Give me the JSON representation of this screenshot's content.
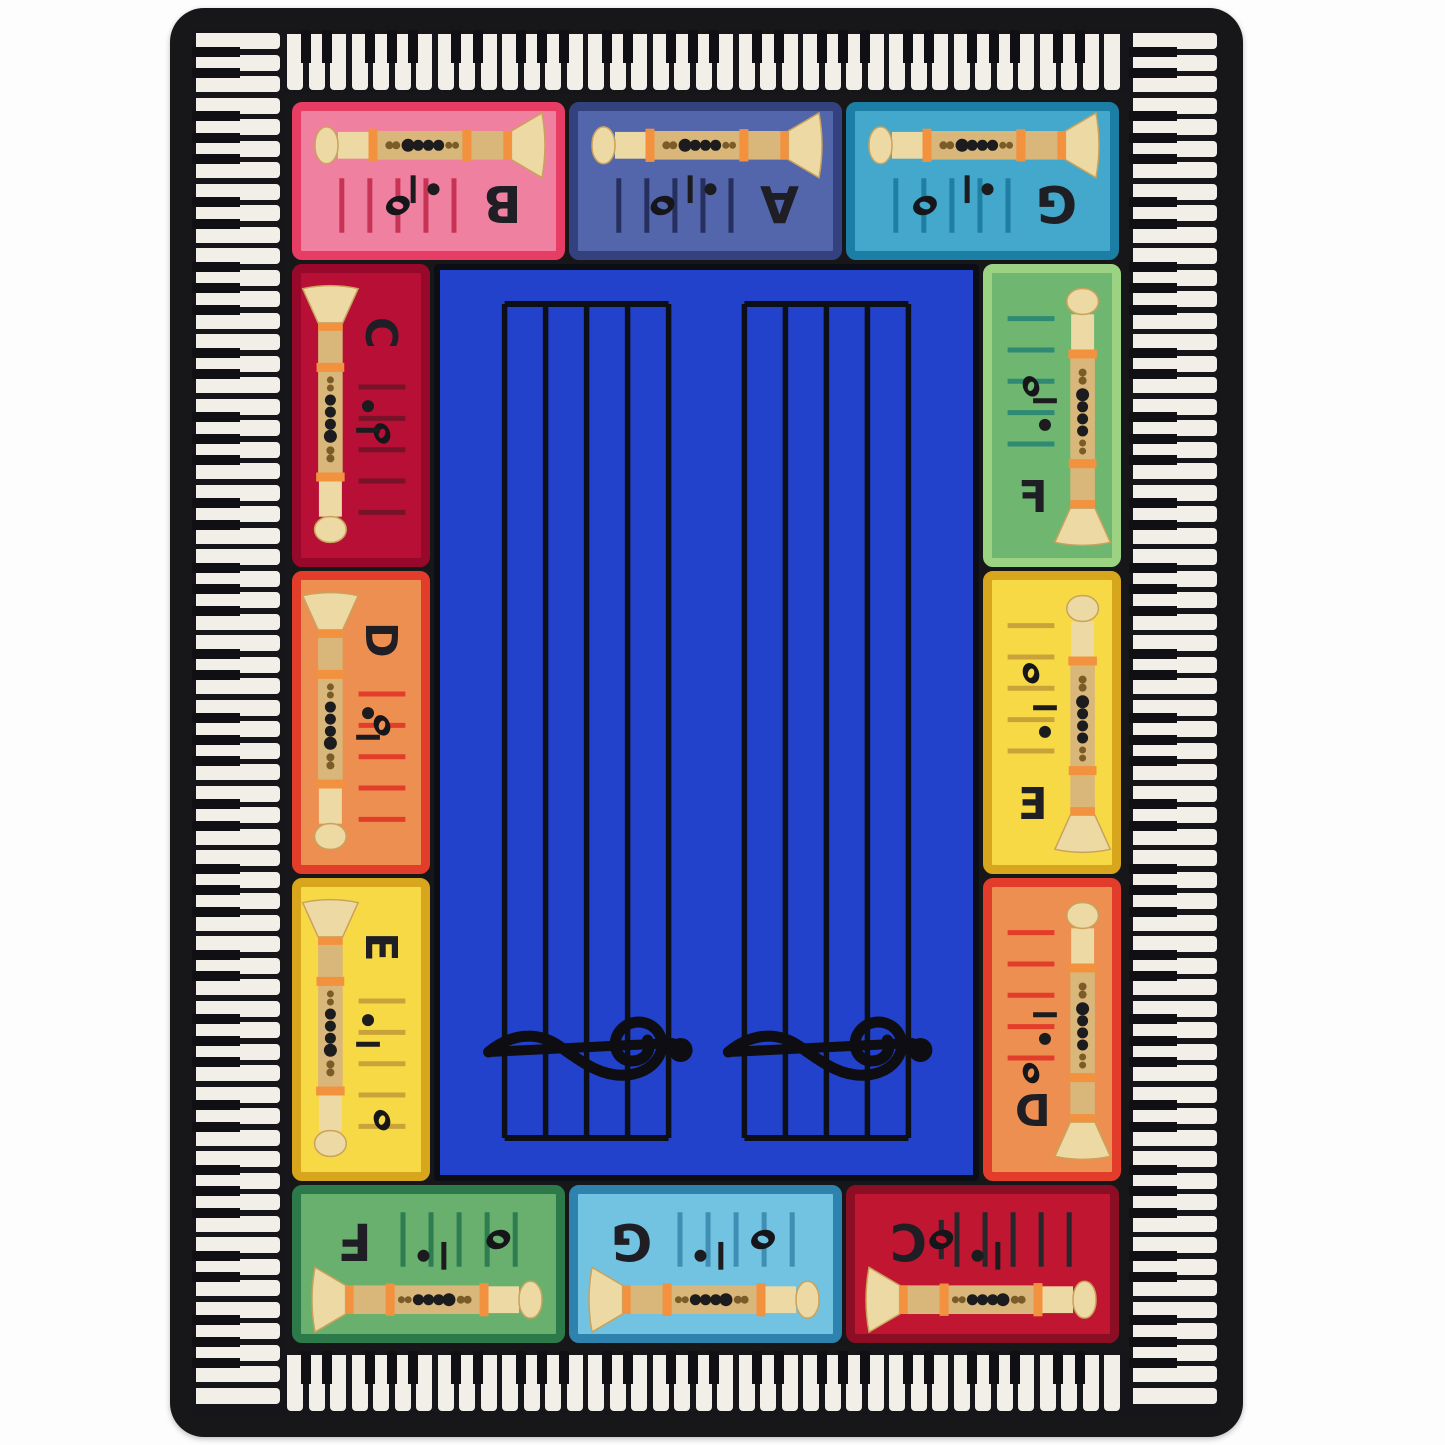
{
  "title": "Recorder fingering classroom rug with piano key border",
  "rug": {
    "base_color": "#17171a",
    "background_color": "#fdfdfd"
  },
  "border_keys": {
    "white_key_color": "#f2efe8",
    "black_key_color": "#101014",
    "strip_background": "#15151a"
  },
  "center": {
    "fill": "#2342cb",
    "staff_line_color": "#0c1016",
    "staff_count": 2,
    "lines_per_staff": 5,
    "clef": "treble",
    "clef_color": "#0d0d12"
  },
  "recorder_colors": {
    "body": "#d9b679",
    "light": "#ecd9a4",
    "band": "#f2913e",
    "hole_dark": "#1c1c1e",
    "hole_brown": "#7a5c28",
    "outline": "#c9a25c"
  },
  "letter_color": "#1e1e24",
  "note_color": "#16161a",
  "panels": [
    {
      "id": "top-1",
      "side": "top",
      "letter": "B",
      "fill": "#f0809f",
      "border": "#e73c63",
      "staff": "#c73355",
      "note_frac": 0.5,
      "ledger": false
    },
    {
      "id": "top-2",
      "side": "top",
      "letter": "A",
      "fill": "#5365ab",
      "border": "#33427e",
      "staff": "#272f5e",
      "note_frac": 0.61,
      "ledger": false
    },
    {
      "id": "top-3",
      "side": "top",
      "letter": "G",
      "fill": "#43a8cb",
      "border": "#1b7fa5",
      "staff": "#1f7fa2",
      "note_frac": 0.74,
      "ledger": false
    },
    {
      "id": "right-1",
      "side": "right",
      "letter": "F",
      "fill": "#6fb671",
      "border": "#9bd383",
      "staff": "#2e8a72",
      "note_frac": 0.46,
      "ledger": false
    },
    {
      "id": "right-2",
      "side": "right",
      "letter": "E",
      "fill": "#f6d945",
      "border": "#d8a61d",
      "staff": "#c9a33a",
      "note_frac": 0.62,
      "ledger": false
    },
    {
      "id": "right-3",
      "side": "right",
      "letter": "D",
      "fill": "#ee8f52",
      "border": "#e23c2a",
      "staff": "#e23c2a",
      "note_frac": -0.12,
      "ledger": false
    },
    {
      "id": "bottom-3",
      "side": "bottom",
      "letter": "C",
      "fill": "#c11631",
      "border": "#8c0e24",
      "staff": "#26262b",
      "note_frac": -0.14,
      "ledger": true
    },
    {
      "id": "bottom-2",
      "side": "bottom",
      "letter": "G",
      "fill": "#72c2e1",
      "border": "#2e82ae",
      "staff": "#3f8fb5",
      "note_frac": 0.74,
      "ledger": false
    },
    {
      "id": "bottom-1",
      "side": "bottom",
      "letter": "F",
      "fill": "#69b06f",
      "border": "#2c7a4a",
      "staff": "#2e7d50",
      "note_frac": 0.85,
      "ledger": false
    },
    {
      "id": "left-3",
      "side": "left",
      "letter": "E",
      "fill": "#f6d945",
      "border": "#d8a61d",
      "staff": "#c9a33a",
      "note_frac": 0.95,
      "ledger": false
    },
    {
      "id": "left-2",
      "side": "left",
      "letter": "D",
      "fill": "#ee8f52",
      "border": "#e23c2a",
      "staff": "#e23c2a",
      "note_frac": 0.25,
      "ledger": false
    },
    {
      "id": "left-1",
      "side": "left",
      "letter": "C",
      "fill": "#b80f36",
      "border": "#97082a",
      "staff": "#771228",
      "note_frac": 0.37,
      "ledger": false
    }
  ]
}
